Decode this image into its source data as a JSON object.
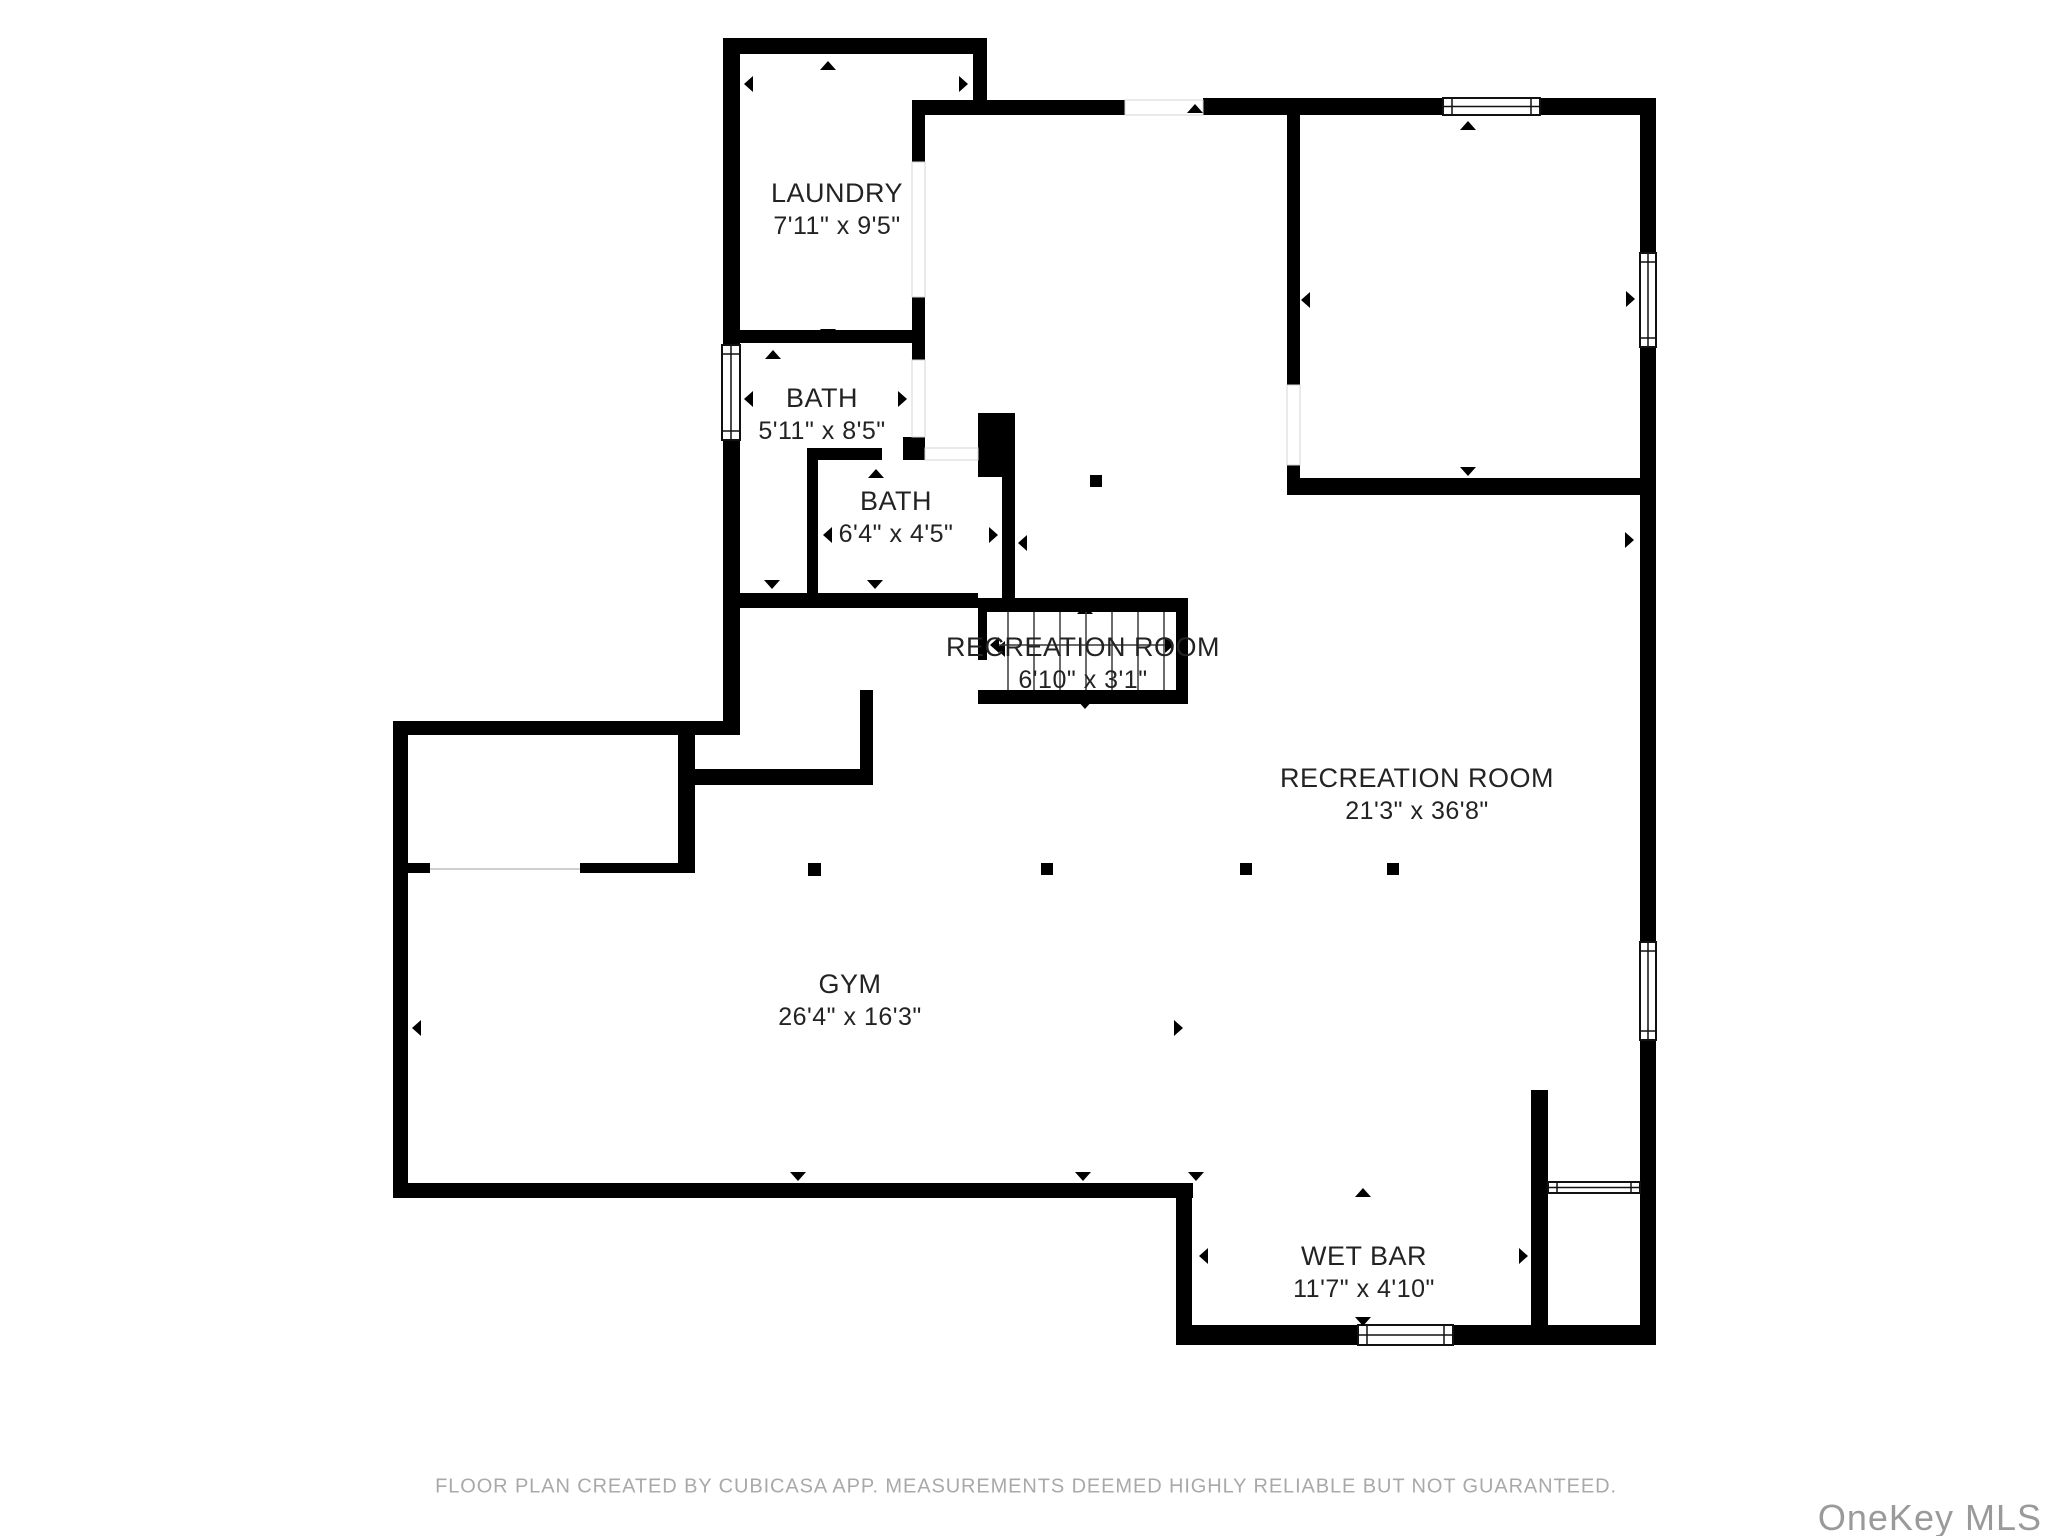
{
  "meta": {
    "app_attribution": "CubiCasa",
    "plan_type": "floor plan"
  },
  "colors": {
    "wall": "#000000",
    "label": "#232323",
    "muted": "#a9a9a9",
    "watermark": "#9a9a9a",
    "stair_line": "#3a3a3a",
    "threshold": "#d4d4d4",
    "window_stroke": "#111111"
  },
  "rooms": [
    {
      "id": "laundry",
      "name": "LAUNDRY",
      "dims": "7'11\" x 9'5\"",
      "cx": 837,
      "cy": 210
    },
    {
      "id": "bath-1",
      "name": "BATH",
      "dims": "5'11\" x 8'5\"",
      "cx": 822,
      "cy": 415
    },
    {
      "id": "bath-2",
      "name": "BATH",
      "dims": "6'4\" x 4'5\"",
      "cx": 896,
      "cy": 518
    },
    {
      "id": "stairs",
      "name": "RECREATION ROOM",
      "dims": "6'10\" x 3'1\"",
      "cx": 1083,
      "cy": 664
    },
    {
      "id": "recreation",
      "name": "RECREATION ROOM",
      "dims": "21'3\" x 36'8\"",
      "cx": 1417,
      "cy": 795
    },
    {
      "id": "gym",
      "name": "GYM",
      "dims": "26'4\" x 16'3\"",
      "cx": 850,
      "cy": 1001
    },
    {
      "id": "wet-bar",
      "name": "WET BAR",
      "dims": "11'7\" x 4'10\"",
      "cx": 1364,
      "cy": 1273
    }
  ],
  "footer": {
    "text": "FLOOR PLAN CREATED BY CUBICASA APP. MEASUREMENTS DEEMED HIGHLY RELIABLE BUT NOT GUARANTEED."
  },
  "watermark": {
    "text": "OneKey MLS"
  },
  "geometry": {
    "canvas": {
      "w": 2048,
      "h": 1536
    },
    "walls": [
      [
        723,
        38,
        264,
        16
      ],
      [
        973,
        38,
        14,
        67
      ],
      [
        723,
        54,
        17,
        681
      ],
      [
        912,
        100,
        213,
        15
      ],
      [
        1203,
        98,
        240,
        17
      ],
      [
        1540,
        98,
        116,
        17
      ],
      [
        912,
        115,
        13,
        47
      ],
      [
        912,
        297,
        13,
        63
      ],
      [
        723,
        330,
        189,
        13
      ],
      [
        903,
        437,
        22,
        23
      ],
      [
        807,
        448,
        75,
        12
      ],
      [
        807,
        460,
        11,
        133
      ],
      [
        978,
        413,
        37,
        64
      ],
      [
        1002,
        477,
        13,
        121
      ],
      [
        723,
        593,
        255,
        15
      ],
      [
        393,
        721,
        347,
        14
      ],
      [
        393,
        735,
        15,
        463
      ],
      [
        678,
        735,
        17,
        138
      ],
      [
        408,
        863,
        22,
        10
      ],
      [
        580,
        863,
        115,
        10
      ],
      [
        695,
        769,
        178,
        16
      ],
      [
        860,
        690,
        13,
        95
      ],
      [
        393,
        1183,
        800,
        15
      ],
      [
        1176,
        1183,
        16,
        162
      ],
      [
        1176,
        1325,
        182,
        20
      ],
      [
        1453,
        1325,
        203,
        20
      ],
      [
        1531,
        1090,
        17,
        235
      ],
      [
        1287,
        115,
        13,
        270
      ],
      [
        1287,
        465,
        13,
        30
      ],
      [
        1295,
        478,
        345,
        17
      ],
      [
        1640,
        98,
        16,
        155
      ],
      [
        1640,
        347,
        16,
        595
      ],
      [
        1640,
        1040,
        16,
        305
      ],
      [
        978,
        598,
        210,
        14
      ],
      [
        978,
        690,
        210,
        14
      ],
      [
        1176,
        598,
        12,
        106
      ],
      [
        978,
        612,
        9,
        48
      ]
    ],
    "doors": [
      [
        912,
        162,
        13,
        135
      ],
      [
        912,
        360,
        13,
        77
      ],
      [
        925,
        448,
        53,
        12
      ],
      [
        1125,
        100,
        78,
        15
      ],
      [
        1287,
        385,
        13,
        80
      ]
    ],
    "opening_lines": [
      [
        430,
        868,
        150,
        2
      ]
    ],
    "windows": [
      [
        722,
        345,
        18,
        95,
        "v"
      ],
      [
        1443,
        98,
        97,
        17,
        "h"
      ],
      [
        1640,
        253,
        16,
        94,
        "v"
      ],
      [
        1640,
        942,
        16,
        98,
        "v"
      ],
      [
        1358,
        1325,
        95,
        20,
        "h"
      ],
      [
        1548,
        1182,
        92,
        11,
        "h"
      ]
    ],
    "posts": [
      [
        808,
        863,
        13,
        13
      ],
      [
        1041,
        863,
        12,
        12
      ],
      [
        1240,
        863,
        12,
        12
      ],
      [
        1387,
        863,
        12,
        12
      ],
      [
        1090,
        475,
        12,
        12
      ]
    ],
    "markers": [
      {
        "x": 828,
        "y": 61,
        "dir": "up"
      },
      {
        "x": 773,
        "y": 350,
        "dir": "up"
      },
      {
        "x": 876,
        "y": 469,
        "dir": "up"
      },
      {
        "x": 1195,
        "y": 104,
        "dir": "up"
      },
      {
        "x": 1468,
        "y": 121,
        "dir": "up"
      },
      {
        "x": 1085,
        "y": 605,
        "dir": "up"
      },
      {
        "x": 1363,
        "y": 1188,
        "dir": "up"
      },
      {
        "x": 828,
        "y": 338,
        "dir": "down"
      },
      {
        "x": 772,
        "y": 589,
        "dir": "down"
      },
      {
        "x": 875,
        "y": 589,
        "dir": "down"
      },
      {
        "x": 1468,
        "y": 476,
        "dir": "down"
      },
      {
        "x": 1085,
        "y": 709,
        "dir": "down"
      },
      {
        "x": 798,
        "y": 1181,
        "dir": "down"
      },
      {
        "x": 1083,
        "y": 1181,
        "dir": "down"
      },
      {
        "x": 1196,
        "y": 1181,
        "dir": "down"
      },
      {
        "x": 1363,
        "y": 1326,
        "dir": "down"
      },
      {
        "x": 744,
        "y": 84,
        "dir": "left"
      },
      {
        "x": 744,
        "y": 399,
        "dir": "left"
      },
      {
        "x": 823,
        "y": 535,
        "dir": "left"
      },
      {
        "x": 996,
        "y": 649,
        "dir": "left"
      },
      {
        "x": 1018,
        "y": 543,
        "dir": "left"
      },
      {
        "x": 1301,
        "y": 300,
        "dir": "left"
      },
      {
        "x": 412,
        "y": 1028,
        "dir": "left"
      },
      {
        "x": 1199,
        "y": 1256,
        "dir": "left"
      },
      {
        "x": 968,
        "y": 84,
        "dir": "right"
      },
      {
        "x": 907,
        "y": 399,
        "dir": "right"
      },
      {
        "x": 998,
        "y": 535,
        "dir": "right"
      },
      {
        "x": 1635,
        "y": 299,
        "dir": "right"
      },
      {
        "x": 1634,
        "y": 540,
        "dir": "right"
      },
      {
        "x": 1183,
        "y": 1028,
        "dir": "right"
      },
      {
        "x": 1528,
        "y": 1256,
        "dir": "right"
      }
    ],
    "stairs": {
      "treads": [
        1008,
        1034,
        1060,
        1086,
        1112,
        1138,
        1164
      ],
      "tread_top": 612,
      "tread_bottom": 690,
      "mid_y": 645,
      "line_x1": 992,
      "line_x2": 1172
    }
  }
}
